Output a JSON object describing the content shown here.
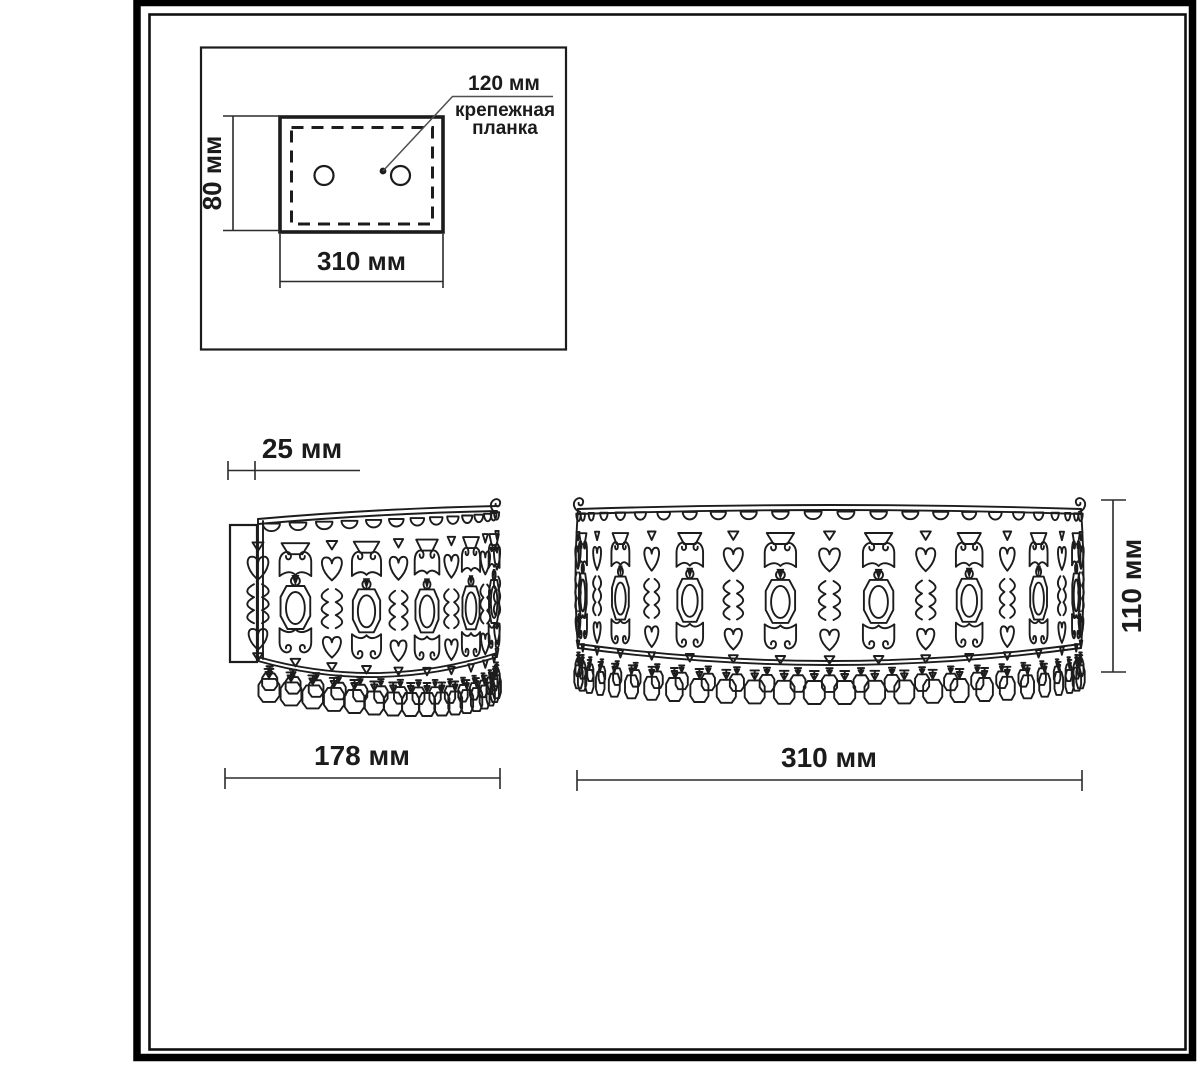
{
  "colors": {
    "paper": "#ffffff",
    "ink": "#1c1c1c",
    "frame": "#000000",
    "leader_line": "#4f4f4f"
  },
  "inset": {
    "dim_height": "80 мм",
    "dim_width": "310 мм",
    "callout_value": "120 мм",
    "callout_line1": "крепежная",
    "callout_line2": "планка"
  },
  "side_view": {
    "dim_depth": "25 мм",
    "dim_width": "178 мм"
  },
  "front_view": {
    "dim_width": "310 мм",
    "dim_height": "110 мм"
  },
  "drawing": {
    "front_medallions": 8,
    "front_scallops": 24,
    "front_beads": 26,
    "side_medallions": 5,
    "side_scallops": 14,
    "side_beads": 17,
    "mount_holes": 2
  }
}
